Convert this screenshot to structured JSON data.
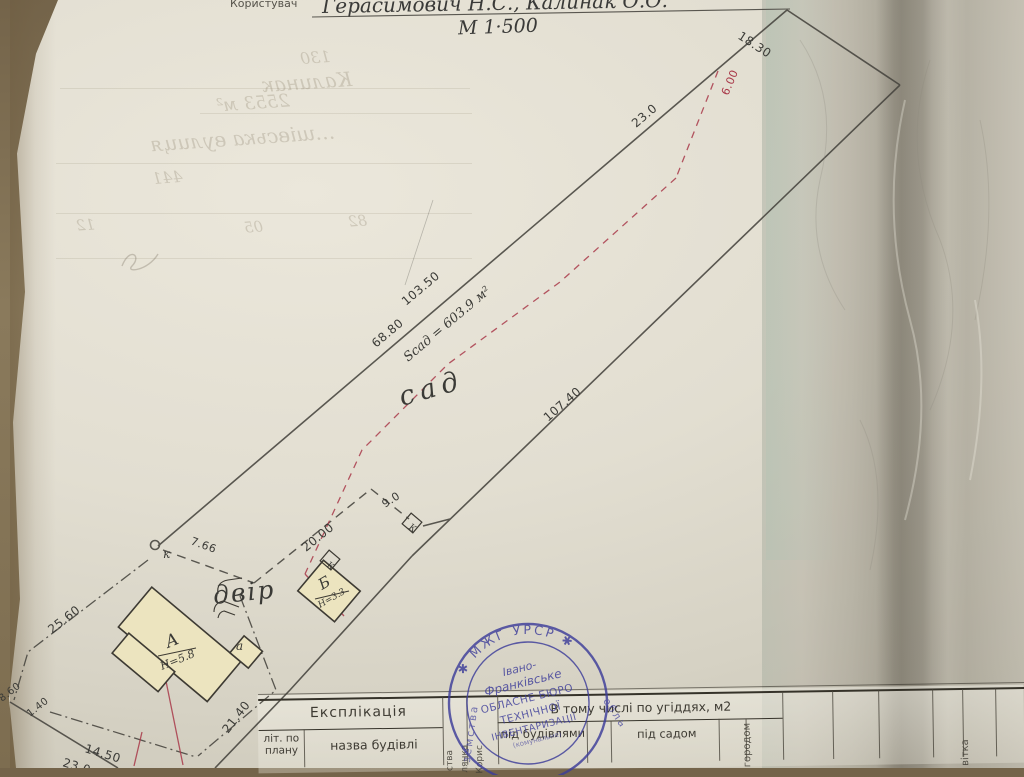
{
  "header": {
    "user_label": "Користувач",
    "owners": "Герасимович Н.С., Калинак О.О.",
    "scale": "М 1·500"
  },
  "plan": {
    "dims": {
      "d1830": "18.30",
      "d230": "23.0",
      "d600": "6.00",
      "d10350": "103.50",
      "d6880": "68.80",
      "d10740": "107.40",
      "d2140": "21.40",
      "d2560": "25.60",
      "d860": "8.60",
      "d140": "1.40",
      "d1450": "14.50",
      "d230b": "23.0",
      "d766": "7.66",
      "d2000": "20.00",
      "d90": "9.0"
    },
    "labels": {
      "garden_area": "Sсад = 603.9 м²",
      "garden": "сад",
      "yard": "двір",
      "k_point": "к",
      "well_a": "К",
      "well_b": "К",
      "bldg_a": "А",
      "bldg_a_h": "Н=5.8",
      "annex": "а",
      "bldg_b": "Б",
      "bldg_b_h": "Н=3.3"
    }
  },
  "bleedthrough": {
    "n130": "130",
    "name": "Калинак",
    "area": "2553 м²",
    "street": "…шівська  вулиця",
    "n441": "441",
    "n12": "12",
    "n05": "05",
    "n82": "82"
  },
  "stamp": {
    "rim_top": "✱  МЖГ  УРСР  ✱",
    "rim_left": "земства",
    "rim_right": "область",
    "c1": "Івано-",
    "c2": "Франківське",
    "c3": "ОБЛАСНЕ БЮРО",
    "c4": "ТЕХНІЧНОЇ",
    "c5": "ІНВЕНТАРИЗАЦІЇ",
    "c6": "(комунальне)"
  },
  "table": {
    "title": "Експлікація",
    "col_lit": "літ. по плану",
    "col_name": "назва будівлі",
    "group": "В тому числі по угіддях, м2",
    "col_bld": "під будівлями",
    "col_sad": "під садом",
    "col_gorod": "городом",
    "col_note": "вітка",
    "rot1": "ства",
    "rot2": "лянка",
    "rot3": "Корис"
  }
}
